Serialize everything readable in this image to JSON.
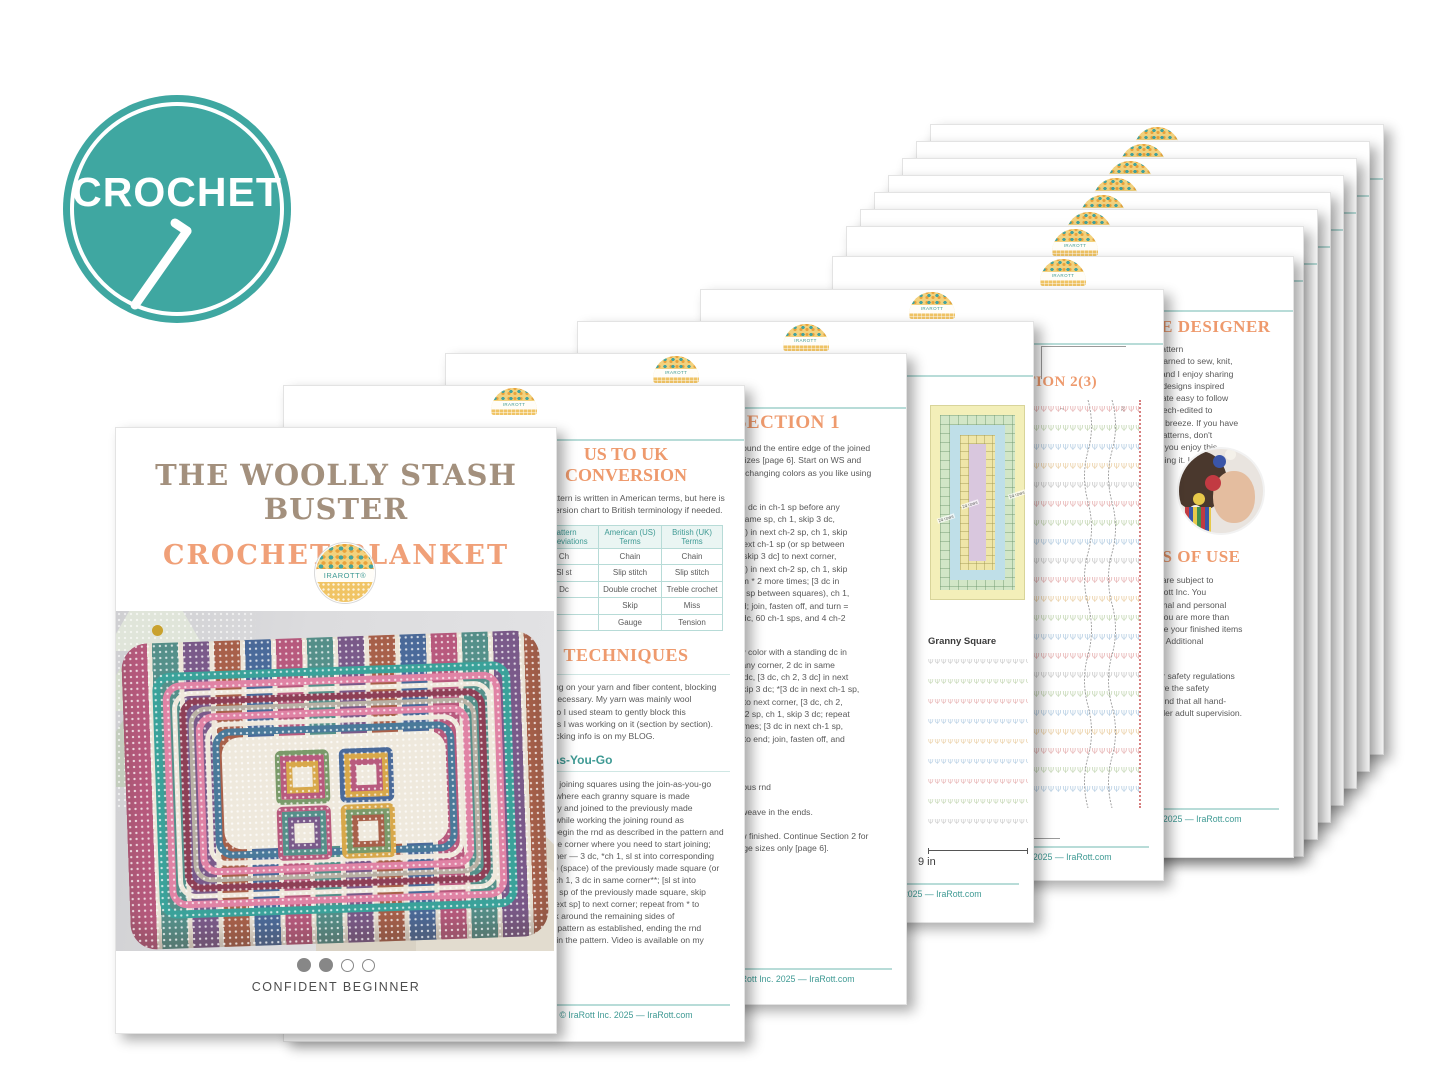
{
  "badge": {
    "text": "CROCHET",
    "color": "#3fa7a1"
  },
  "brand": {
    "logo_text": "IRAROTT",
    "logo_text_r": "IRAROTT®",
    "footer": "© IraRott Inc. 2025 — IraRott.com",
    "teal": "#3f9a94",
    "orange": "#ee9a6d",
    "link_blue": "#5b9bd5"
  },
  "cover": {
    "title_line1": "THE WOOLLY STASH BUSTER",
    "title_line2": "CROCHET BLANKET",
    "difficulty_label": "CONFIDENT BEGINNER",
    "difficulty_filled": 2,
    "difficulty_total": 4
  },
  "uk_page": {
    "heading": "US TO UK CONVERSION",
    "intro_lines": [
      "This pattern is written in American terms, but here is",
      "a conversion chart to British terminology if needed."
    ],
    "table": {
      "headers": [
        "Pattern Abbreviations",
        "American (US) Terms",
        "British (UK) Terms"
      ],
      "rows": [
        [
          "Ch",
          "Chain",
          "Chain"
        ],
        [
          "Sl st",
          "Slip stitch",
          "Slip stitch"
        ],
        [
          "Dc",
          "Double crochet",
          "Treble crochet"
        ],
        [
          "",
          "Skip",
          "Miss"
        ],
        [
          "",
          "Gauge",
          "Tension"
        ]
      ]
    },
    "techniques_heading": "TECHNIQUES",
    "blocking_lines": [
      "Depending on your yarn and fiber content, blocking",
      "may be necessary. My yarn was mainly wool",
      "blends, so I used steam to gently block this",
      "blanket as I was working on it (section by section).",
      "More blocking info is on my BLOG."
    ],
    "jayg_heading": "Join-As-You-Go",
    "jayg_lines": [
      "I suggest joining squares using the join-as-you-go",
      "method, where each granny square is made",
      "separately and joined to the previously made",
      "squares while working the joining round as",
      "follows: begin the rnd as described in the pattern and",
      "stop at the corner where you need to start joining;",
      "work corner — 3 dc, *ch 1, sl st into corresponding",
      "corner sp (space) of the previously made square (or",
      "corner), ch 1, 3 dc in same corner**; [sl st into",
      "matching sp of the previously made square, skip",
      "ch 1 of next sp] to next corner; repeat from * to",
      "** to work around the remaining sides of",
      "squares, pattern as established, ending the rnd",
      "as given in the pattern. Video is available on my"
    ]
  },
  "section1_page": {
    "heading": "SECTION 1",
    "intro_lines": [
      "Work edging around the entire edge of the joined",
      "squares for all sizes [page 6]. Start on WS and",
      "work every rnd, changing colors as you like using",
      "your yarn stash."
    ],
    "rnd1_lines": [
      "Rnd 1: Standing dc in ch-1 sp before any",
      "corner, 2 dc in same sp, ch 1, skip 3 dc,",
      "(3 dc, ch 2, 3 dc) in next ch-2 sp, ch 1, skip",
      "3 dc; *[3 dc in next ch-1 sp (or sp between",
      "squares), ch 1, skip 3 dc] to next corner,",
      "(3 dc, ch 2, 3 dc) in next ch-2 sp, ch 1, skip",
      "3 dc; repeat from * 2 more times; [3 dc in",
      "next ch-1 sp (or sp between squares), ch 1,",
      "skip 3 dc] to end; join, fasten off, and turn =",
      "64 groups of 3-dc, 60 ch-1 sps, and 4 ch-2",
      "corners"
    ],
    "rnd2_lines": [
      "Rnd 2: Join new color with a standing dc in",
      "ch-1 sp before any corner, 2 dc in same",
      "sp, ch 1, skip 3 dc, [3 dc, ch 2, 3 dc] in next",
      "ch-2 sp, ch 1, skip 3 dc; *[3 dc in next ch-1 sp,",
      "ch 1, skip 3 dc] to next corner, [3 dc, ch 2,",
      "3 dc] in next ch-2 sp, ch 1, skip 3 dc; repeat",
      "from * 2 more times; [3 dc in next ch-1 sp,",
      "ch 1, skip 3 dc] to end; join, fasten off, and",
      "turn"
    ],
    "small_lines": [
      "Small size only:",
      "Rnd 3: As previous rnd"
    ],
    "finish_line": "Fasten off and weave in the ends.",
    "continue_lines": [
      "Section 1 is now finished. Continue Section 2 for",
      "medium and large sizes only [page 6]."
    ]
  },
  "diagram_page": {
    "square_label": "Granny Square",
    "size_label": "9 in",
    "rows_label": "24 rows"
  },
  "section2_page": {
    "heading": "SECTION 2(3)",
    "row_start_label": "1",
    "row_end_label": "24"
  },
  "designer_page": {
    "heading": "MEET THE DESIGNER",
    "bio_lines": [
      "Ira Rott is a Canadian pattern",
      "designer and author. I learned to sew, knit,",
      "crochet at a young age and I enjoy sharing",
      "my passion through my designs inspired",
      "by modern trends to create easy to follow",
      "patterns, all tested and tech-edited to",
      "make your experience a breeze. If you have",
      "any questions with my patterns, don't",
      "hesitate to email. I hope you enjoy this",
      "pattern as I loved designing it. I can't wait",
      "to see your photos."
    ],
    "terms_heading": "TERMS OF USE",
    "terms_lines": [
      "All patterns and graphs are subject to",
      "copyright owned by IraRott Inc. You",
      "may use it for informational and personal",
      "use (no redistribution). You are more than",
      "welcome to sell or donate your finished items",
      "made on a limited basis. Additional",
      "info at: IraRott.com"
    ],
    "safety_lines": [
      "Please use this guide for safety regulations",
      "and certification to ensure the safety",
      "standards. We recommend that all hand-",
      "made items be used under adult supervision."
    ]
  },
  "glyphs": {
    "chart_row": "ΨΨΨΨΨΨΨΨΨΨΨΨΨΨΨΨΨΨΨΨΨΨΨΨΨΨΨΨΨΨ"
  }
}
